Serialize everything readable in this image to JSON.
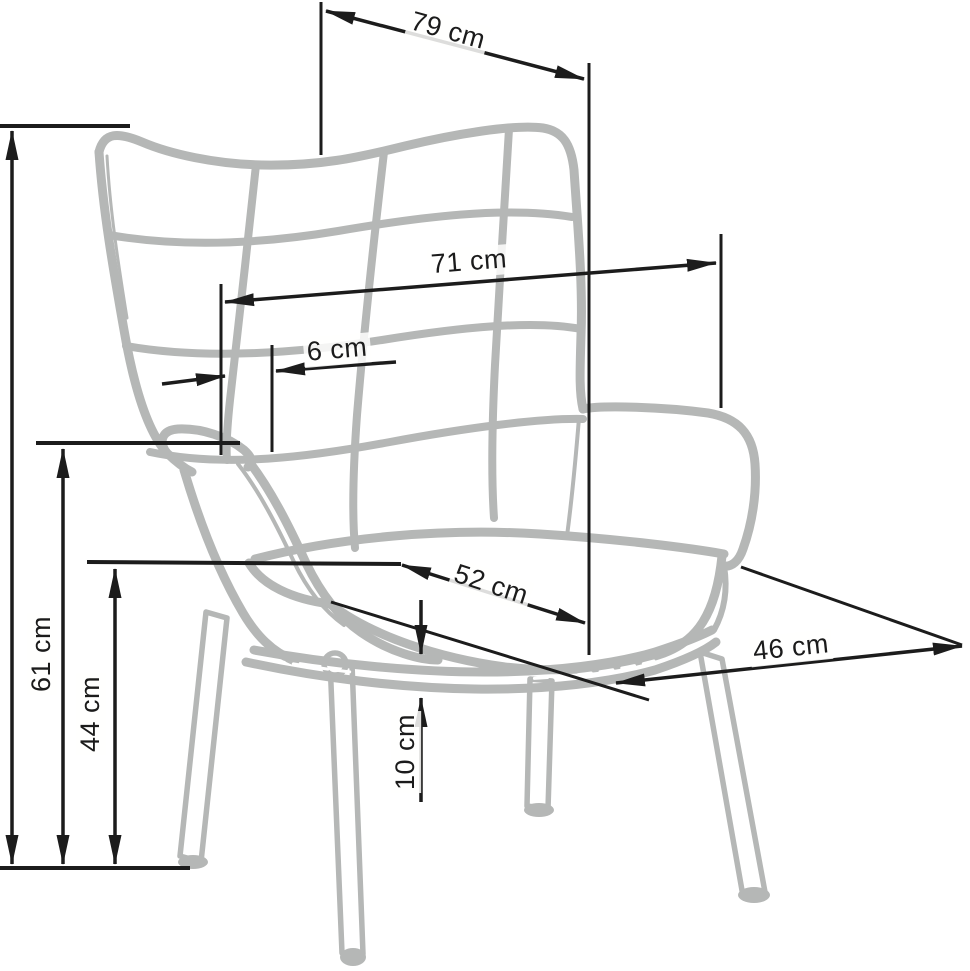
{
  "diagram": {
    "subject": "wingback armchair dimension drawing",
    "unit": "cm",
    "background_color": "#ffffff",
    "sketch_color": "#b5b7b6",
    "dimension_color": "#1c1c1c",
    "dimensions": [
      {
        "id": "overall-width-top",
        "label": "79 cm",
        "value": 79,
        "unit": "cm"
      },
      {
        "id": "backrest-width",
        "label": "71 cm",
        "value": 71,
        "unit": "cm"
      },
      {
        "id": "wing-offset",
        "label": "6 cm",
        "value": 6,
        "unit": "cm"
      },
      {
        "id": "seat-width",
        "label": "52 cm",
        "value": 52,
        "unit": "cm"
      },
      {
        "id": "seat-depth",
        "label": "46 cm",
        "value": 46,
        "unit": "cm"
      },
      {
        "id": "armrest-height",
        "label": "61 cm",
        "value": 61,
        "unit": "cm"
      },
      {
        "id": "seat-height",
        "label": "44 cm",
        "value": 44,
        "unit": "cm"
      },
      {
        "id": "underframe-gap",
        "label": "10 cm",
        "value": 10,
        "unit": "cm"
      }
    ]
  }
}
